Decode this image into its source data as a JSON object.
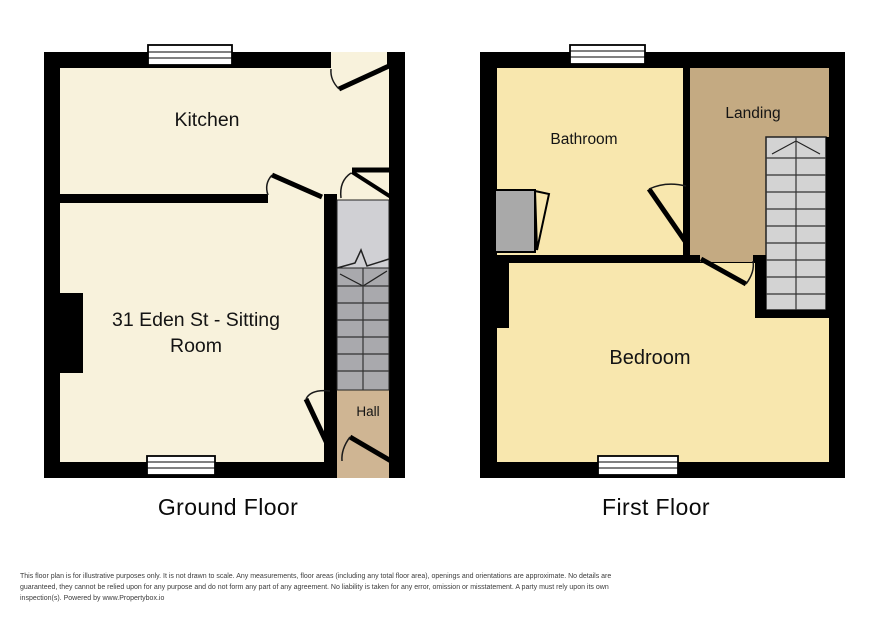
{
  "meta": {
    "width": 886,
    "height": 620
  },
  "colors": {
    "wall": "#000000",
    "ground_room_fill": "#f8f2dc",
    "first_room_fill": "#f8e7ae",
    "hall_fill": "#cfb593",
    "landing_fill": "#c4aa82",
    "stair_light_gray": "#d0d0d4",
    "stair_dark_gray": "#a9a9ad",
    "shower_gray": "#a9a9a9",
    "window_fill": "#ffffff",
    "disclaimer_text": "#3c3c3c"
  },
  "plans": {
    "ground": {
      "title": "Ground Floor",
      "labels": {
        "kitchen": "Kitchen",
        "sitting_line1": "31 Eden St - Sitting",
        "sitting_line2": "Room",
        "hall": "Hall"
      }
    },
    "first": {
      "title": "First Floor",
      "labels": {
        "bathroom": "Bathroom",
        "landing": "Landing",
        "bedroom": "Bedroom"
      }
    }
  },
  "footer": {
    "disclaimer": "This floor plan is for illustrative purposes only. It is not drawn to scale. Any measurements, floor areas (including any total floor area), openings and orientations are approximate. No details are guaranteed, they cannot be relied upon for any purpose and do not form any part of any agreement. No liability is taken for any error, omission or misstatement. A party must rely upon its own inspection(s). Powered by www.Propertybox.io"
  }
}
